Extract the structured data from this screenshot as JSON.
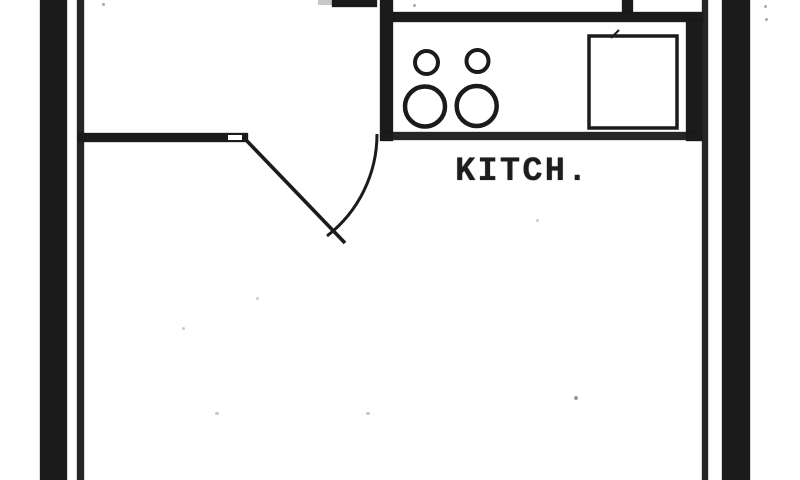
{
  "floorplan": {
    "room_label": "KITCH.",
    "colors": {
      "ink": "#1b1b1b",
      "line": "#262626",
      "paper": "#ffffff"
    },
    "fixtures": [
      {
        "name": "stove-cooktop",
        "burners": 4
      },
      {
        "name": "kitchen-sink"
      },
      {
        "name": "door-swing"
      }
    ]
  }
}
